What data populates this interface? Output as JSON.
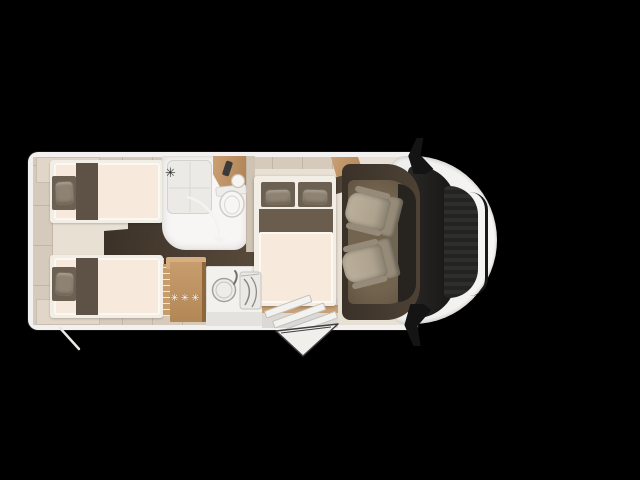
{
  "scene": {
    "description": "Top-down floor plan of a semi-integrated motorhome on black background, cab facing right",
    "background": "#000000"
  },
  "fridge": {
    "label": "✳✳✳"
  },
  "icons": {
    "shower_head_glyph": "✳"
  },
  "palette": {
    "bg": "#000000",
    "shell": "#f2f1ef",
    "shell-a": "#ededeb",
    "shell-b": "#f7f6f4",
    "wall": "#d6cabc",
    "wall-seam": "#c2b6a8",
    "wall2": "#cfc3b4",
    "floor": "#e8e0d3",
    "locker": "#e1d6c8",
    "locker-edge": "#c9bdaf",
    "aisle-a": "#3a3026",
    "aisle-b": "#594b3c",
    "bed-base": "#f2ede5",
    "mattress": "#f7e9dc",
    "mattress-edge": "#fbf7f1",
    "runner": "#5e5246",
    "upholstery": "#6b6052",
    "pillow": "#8e8372",
    "pillow-edge": "#776d5d",
    "duvet": "#6a5d4e",
    "room": "#f7f6f4",
    "tray": "#ebeae6",
    "tray-edge": "#d3d2ce",
    "wood-a": "#c9a074",
    "wood-b": "#ad8052",
    "wood-front-a": "#c89d6e",
    "wood-front-b": "#b38755",
    "wood-side": "#8d6639",
    "wood-top": "#d7ae7f",
    "counter": "#f2f1ee",
    "counter-edge": "#dcdad6",
    "counter-base": "#e4e2de",
    "entry": "#dbd9d5",
    "cab-a": "#3a3129",
    "cab-b": "#4d4234",
    "cabfloor-a": "#73644f",
    "cabfloor-b": "#5d4f3f",
    "dash": "#27231e",
    "seat-a": "#bbb09c",
    "seat-b": "#a89d89",
    "seat-c": "#968b78",
    "glass-a": "#2a2724",
    "glass-b": "#161616",
    "grille-a": "#2e2e2c",
    "grille-b": "#232321",
    "trim": "#191919",
    "mirror": "#141414",
    "icon-dark": "#2f2f2f",
    "star": "#ffffff"
  }
}
